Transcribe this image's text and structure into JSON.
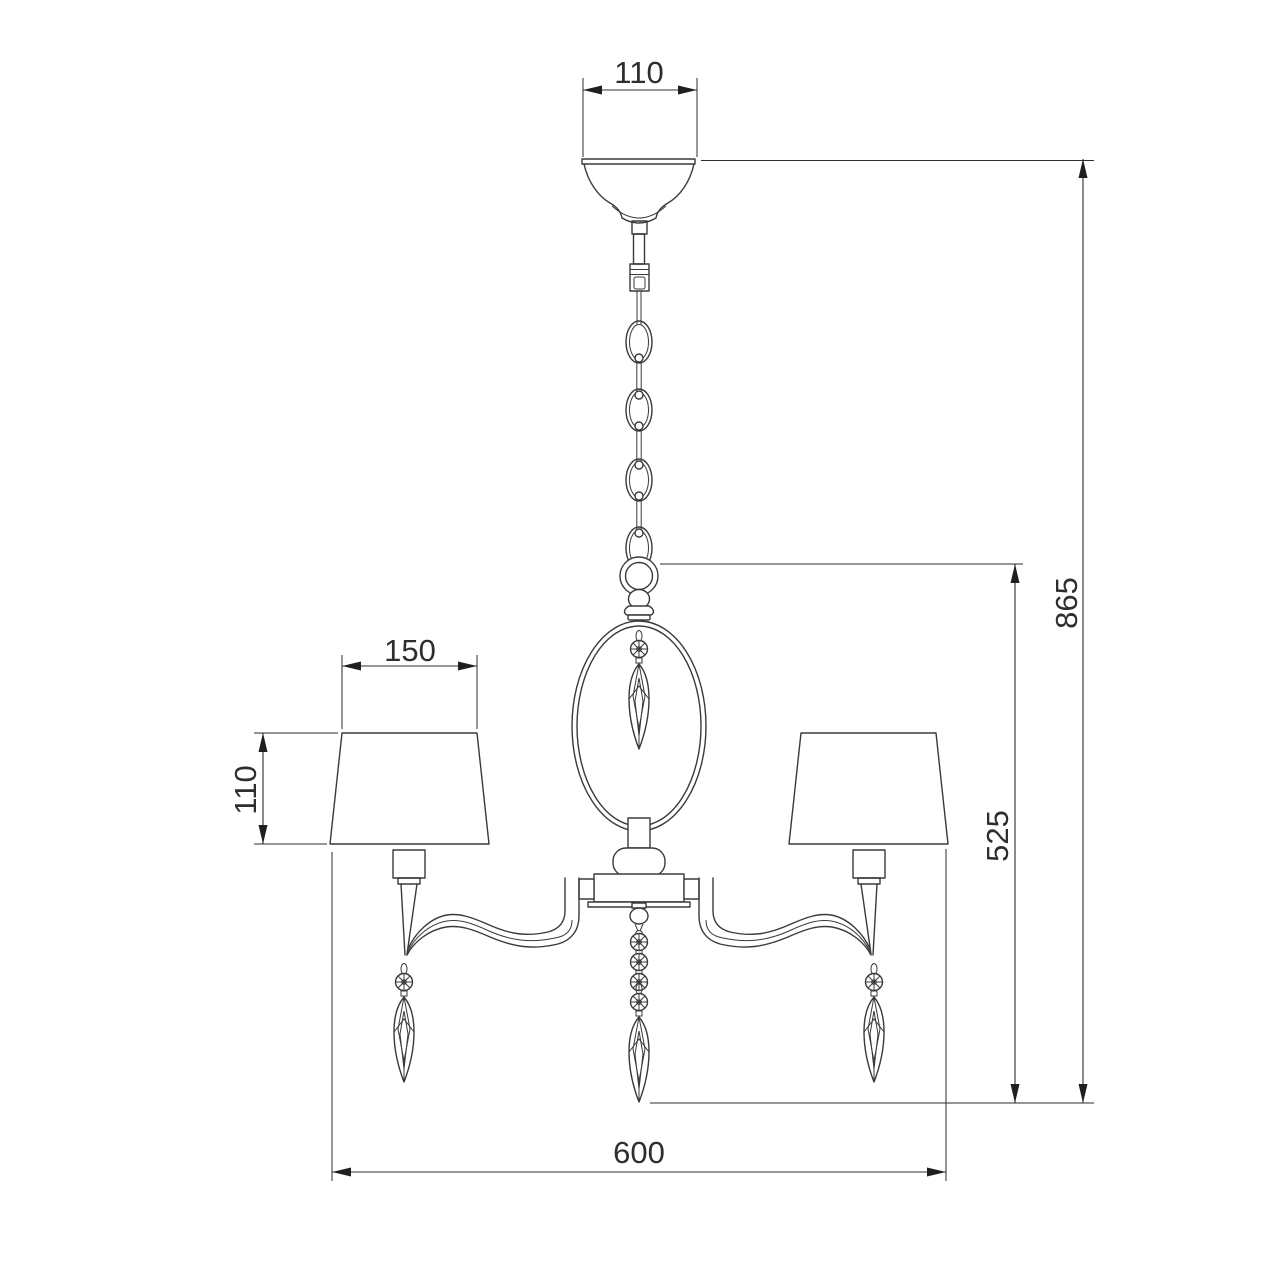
{
  "drawing": {
    "title": "Chandelier technical dimension drawing",
    "background_color": "#ffffff",
    "line_color": "#3a3a3a",
    "dimension_color": "#2e2e2e",
    "dimensions": {
      "canopy_width": "110",
      "shade_width": "150",
      "shade_height": "110",
      "overall_height": "865",
      "body_height": "525",
      "overall_width": "600"
    }
  }
}
